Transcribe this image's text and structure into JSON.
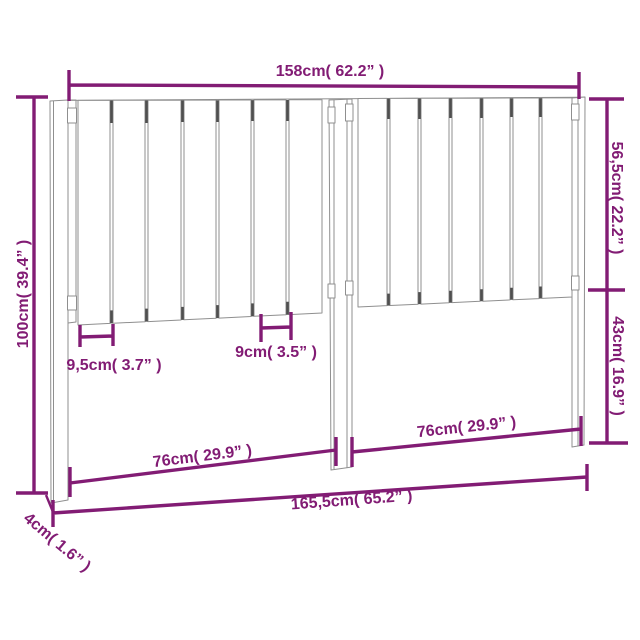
{
  "diagram": {
    "product": "Bed headboard with vertical slats, three legs and connector brackets",
    "view": "front perspective line drawing with dimension annotations",
    "style": {
      "accent_color": "#821c74",
      "line_color": "#8f8f8f",
      "shadow_line_color": "#4f4f4f",
      "background_color": "#ffffff"
    },
    "labels": {
      "top_width": "158cm( 62.2” )",
      "left_height": "100cm( 39.4” )",
      "right_upper_height": "56,5cm( 22.2” )",
      "right_lower_height": "43cm( 16.9” )",
      "first_slat_width": "9,5cm( 3.7” )",
      "slat_width": "9cm( 3.5” )",
      "left_opening_width": "76cm( 29.9” )",
      "right_opening_width": "76cm( 29.9” )",
      "total_width": "165,5cm( 65.2” )",
      "leg_thickness": "4cm( 1.6” )"
    },
    "measurements": [
      {
        "name": "slatted panel width (top)",
        "cm": "158",
        "inches": "62.2"
      },
      {
        "name": "total height",
        "cm": "100",
        "inches": "39.4"
      },
      {
        "name": "upper slatted section height",
        "cm": "56,5",
        "inches": "22.2"
      },
      {
        "name": "lower open section height",
        "cm": "43",
        "inches": "16.9"
      },
      {
        "name": "first slat spacing",
        "cm": "9,5",
        "inches": "3.7"
      },
      {
        "name": "slat width",
        "cm": "9",
        "inches": "3.5"
      },
      {
        "name": "left leg opening width",
        "cm": "76",
        "inches": "29.9"
      },
      {
        "name": "right leg opening width",
        "cm": "76",
        "inches": "29.9"
      },
      {
        "name": "total width (bottom)",
        "cm": "165,5",
        "inches": "65.2"
      },
      {
        "name": "leg thickness",
        "cm": "4",
        "inches": "1.6"
      }
    ]
  }
}
